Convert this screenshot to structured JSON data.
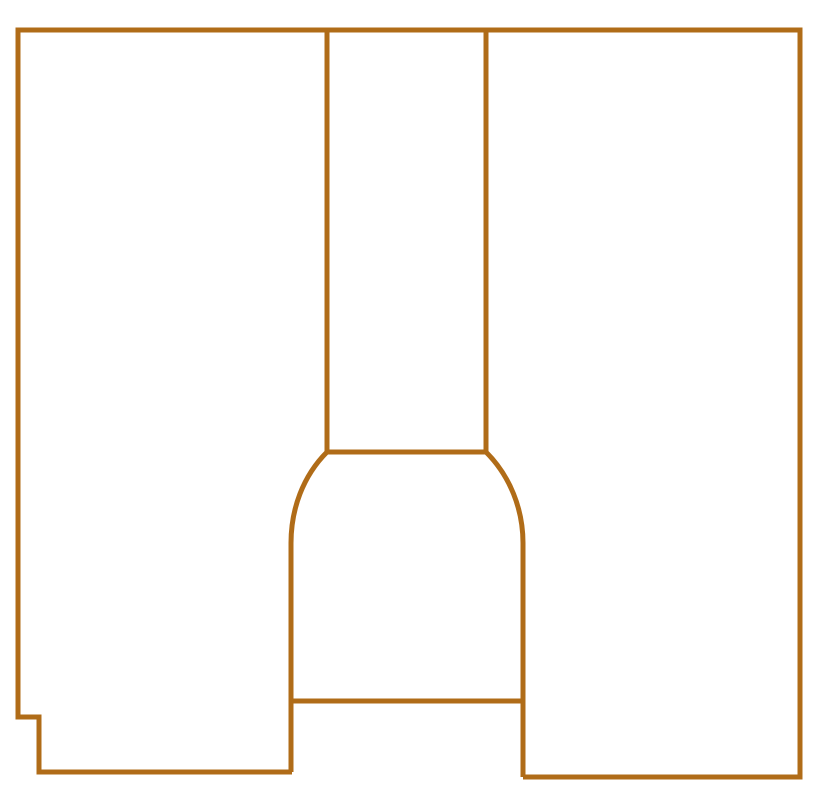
{
  "canvas": {
    "width": 817,
    "height": 810,
    "background_color": "#ffffff"
  },
  "style": {
    "line_color": "#B06C18",
    "line_width": 5
  },
  "figure": {
    "description": "Line drawing: stepped rectangular outline containing a central vertical channel that flares through 45-degree arcs into a bell-shaped lower section, open at the bottom edge between the bell walls",
    "paths": [
      {
        "name": "outer-outline",
        "d": "M 292 772 L 39 772 L 39 717 L 18 717 L 18 30 L 800 30 L 800 777 L 523 777"
      },
      {
        "name": "channel-left-line",
        "d": "M 327 30 L 327 452"
      },
      {
        "name": "channel-right-line",
        "d": "M 486 30 L 486 452"
      },
      {
        "name": "channel-base-line",
        "d": "M 327 452 L 486 452"
      },
      {
        "name": "bell-left-line",
        "d": "M 327 452 C 303 476 291 509 291 543 L 291 772"
      },
      {
        "name": "bell-right-line",
        "d": "M 486 452 C 510 476 523 509 523 543 L 523 777"
      },
      {
        "name": "bell-bottom-line",
        "d": "M 291 701 L 523 701"
      }
    ]
  }
}
